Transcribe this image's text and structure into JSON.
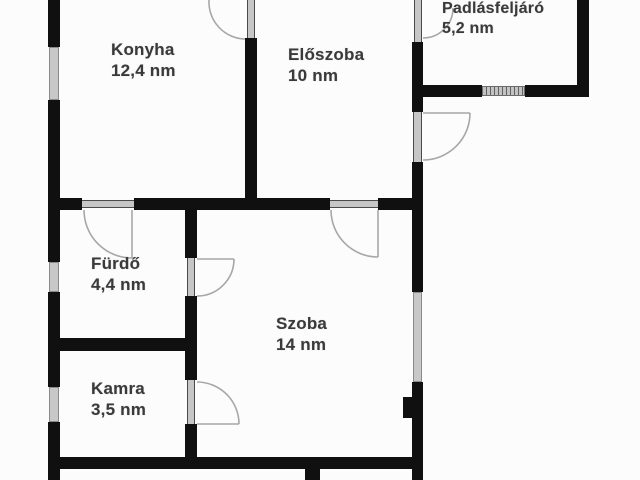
{
  "plan_type": "floor-plan",
  "language": "hu",
  "area_unit": "nm",
  "rooms": [
    {
      "id": "konyha",
      "name": "Konyha",
      "area": "12,4 nm"
    },
    {
      "id": "eloszoba",
      "name": "Előszoba",
      "area": "10 nm"
    },
    {
      "id": "padlasfeljaro",
      "name": "Padlásfeljáró",
      "area": "5,2 nm"
    },
    {
      "id": "furdo",
      "name": "Fürdő",
      "area": "4,4 nm"
    },
    {
      "id": "szoba",
      "name": "Szoba",
      "area": "14 nm"
    },
    {
      "id": "kamra",
      "name": "Kamra",
      "area": "3,5 nm"
    }
  ],
  "colors": {
    "wall": "#101010",
    "window_fill": "#c8c8c8",
    "door_arc": "#a7a7a7",
    "label_text": "#3a3a3a",
    "background": "#fcfcfc"
  }
}
